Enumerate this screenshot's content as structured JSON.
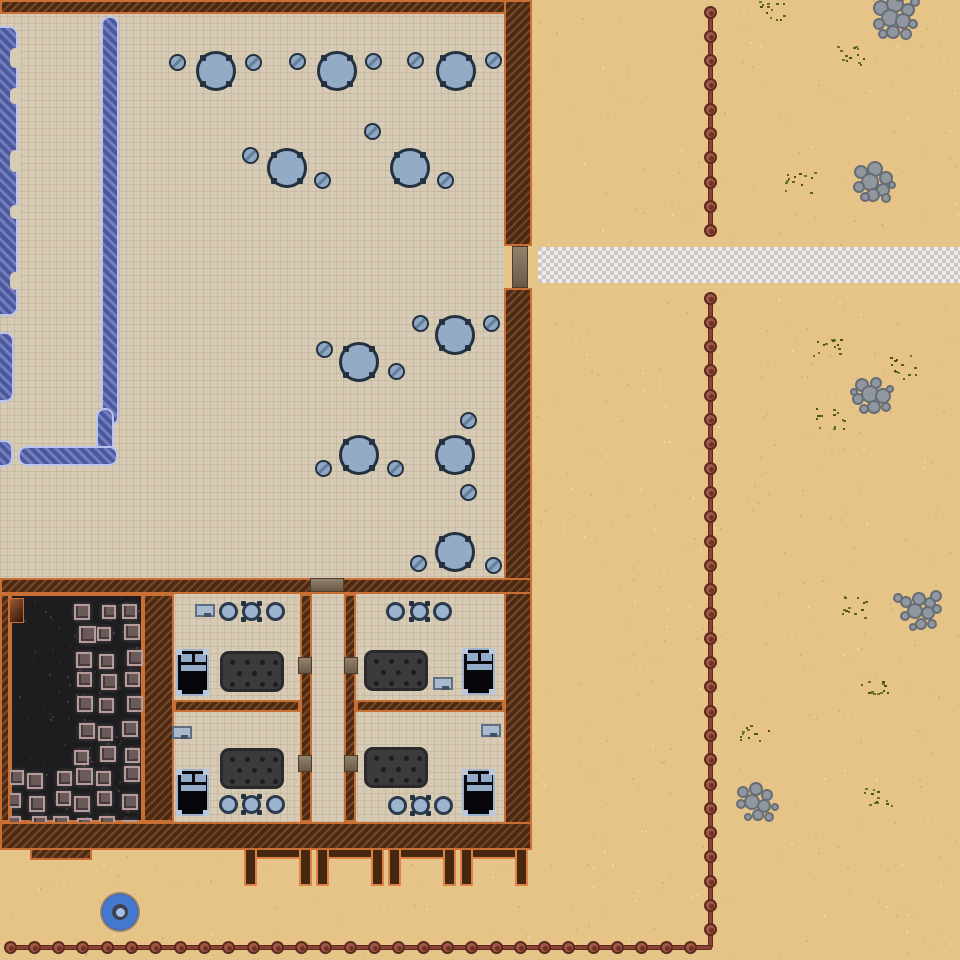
{
  "scene": {
    "type": "top-down-colony-map",
    "canvas": {
      "w": 960,
      "h": 960
    }
  },
  "palette": {
    "sand": "#e6c488",
    "floor": "#d8cbb6",
    "wall": "#4b2a15",
    "wall_edge": "#c96f33",
    "field": "#1d1c1e",
    "blueprint": "#4c589b",
    "blueprint_edge": "#b9c4ee",
    "table": "#94abc6",
    "outline": "#233140",
    "road_light": "#eeedea",
    "road_dark": "#c9c6c2",
    "fence": "#a05846",
    "rock": "#9097a0",
    "grass": "#5a641c",
    "door": "#8d7c66",
    "bed_frame": "#9db3cc",
    "rug": "#3b3b3d",
    "crate": "#6a5a5a",
    "crate_edge": "#b79b9b",
    "disc": "#4579cf"
  },
  "floors": [
    [
      0,
      14,
      504,
      808
    ]
  ],
  "walls": [
    [
      0,
      0,
      532,
      14
    ],
    [
      504,
      0,
      28,
      246
    ],
    [
      504,
      288,
      28,
      558
    ],
    [
      0,
      578,
      532,
      16
    ],
    [
      0,
      594,
      10,
      228
    ],
    [
      143,
      594,
      31,
      228
    ],
    [
      300,
      594,
      12,
      228
    ],
    [
      344,
      594,
      12,
      228
    ],
    [
      174,
      700,
      126,
      12
    ],
    [
      356,
      700,
      148,
      12
    ],
    [
      0,
      822,
      532,
      28
    ],
    [
      30,
      848,
      62,
      12
    ]
  ],
  "doors": [
    [
      512,
      246,
      16,
      42
    ],
    [
      310,
      578,
      34,
      14
    ],
    [
      298,
      657,
      14,
      17
    ],
    [
      344,
      657,
      14,
      17
    ],
    [
      298,
      755,
      14,
      17
    ],
    [
      344,
      755,
      14,
      17
    ]
  ],
  "road": [
    538,
    247,
    422,
    36
  ],
  "blueprints": {
    "strips": [
      [
        101,
        16,
        18,
        410
      ],
      [
        96,
        408,
        18,
        50
      ],
      [
        18,
        446,
        100,
        20
      ],
      [
        -8,
        26,
        26,
        290
      ],
      [
        -8,
        332,
        22,
        70
      ],
      [
        -8,
        440,
        21,
        27
      ]
    ],
    "notches": [
      [
        10,
        48,
        10,
        20
      ],
      [
        10,
        88,
        10,
        16
      ],
      [
        10,
        150,
        10,
        22
      ],
      [
        10,
        205,
        10,
        14
      ],
      [
        10,
        272,
        10,
        18
      ]
    ]
  },
  "tables": [
    [
      216,
      71
    ],
    [
      337,
      71
    ],
    [
      456,
      71
    ],
    [
      287,
      168
    ],
    [
      410,
      168
    ],
    [
      359,
      362
    ],
    [
      455,
      335
    ],
    [
      359,
      455
    ],
    [
      455,
      455
    ],
    [
      455,
      552
    ]
  ],
  "stools": [
    [
      177,
      62
    ],
    [
      253,
      62
    ],
    [
      297,
      61
    ],
    [
      373,
      61
    ],
    [
      415,
      60
    ],
    [
      493,
      60
    ],
    [
      250,
      155
    ],
    [
      322,
      180
    ],
    [
      372,
      131
    ],
    [
      445,
      180
    ],
    [
      324,
      349
    ],
    [
      396,
      371
    ],
    [
      420,
      323
    ],
    [
      491,
      323
    ],
    [
      323,
      468
    ],
    [
      395,
      468
    ],
    [
      468,
      420
    ],
    [
      468,
      492
    ],
    [
      418,
      563
    ],
    [
      493,
      565
    ]
  ],
  "bedrooms": {
    "beds": [
      [
        176,
        649
      ],
      [
        462,
        648
      ],
      [
        176,
        769
      ],
      [
        462,
        769
      ]
    ],
    "rugs": [
      [
        220,
        651
      ],
      [
        364,
        650
      ],
      [
        220,
        748
      ],
      [
        364,
        747
      ]
    ],
    "pots": [
      [
        228,
        611
      ],
      [
        251,
        611
      ],
      [
        275,
        611
      ],
      [
        395,
        611
      ],
      [
        419,
        611
      ],
      [
        442,
        611
      ],
      [
        228,
        804
      ],
      [
        251,
        804
      ],
      [
        275,
        804
      ],
      [
        397,
        805
      ],
      [
        420,
        805
      ],
      [
        443,
        805
      ]
    ],
    "pot_tab_indices": [
      1,
      4,
      7,
      10
    ],
    "dressers": [
      [
        195,
        604
      ],
      [
        433,
        677
      ],
      [
        172,
        726
      ],
      [
        481,
        724
      ]
    ]
  },
  "field": {
    "rect": [
      10,
      594,
      133,
      228
    ],
    "hopper": [
      2,
      598,
      22,
      25
    ],
    "crates": [
      [
        74,
        604,
        16
      ],
      [
        102,
        605,
        14
      ],
      [
        122,
        604,
        15
      ],
      [
        79,
        626,
        17
      ],
      [
        97,
        627,
        14
      ],
      [
        124,
        624,
        16
      ],
      [
        76,
        652,
        16
      ],
      [
        99,
        654,
        15
      ],
      [
        127,
        650,
        16
      ],
      [
        77,
        672,
        15
      ],
      [
        101,
        674,
        16
      ],
      [
        125,
        672,
        15
      ],
      [
        77,
        696,
        16
      ],
      [
        99,
        698,
        15
      ],
      [
        127,
        696,
        16
      ],
      [
        79,
        723,
        16
      ],
      [
        98,
        726,
        15
      ],
      [
        122,
        721,
        16
      ],
      [
        74,
        750,
        15
      ],
      [
        100,
        746,
        16
      ],
      [
        125,
        748,
        15
      ],
      [
        9,
        770,
        15
      ],
      [
        27,
        773,
        16
      ],
      [
        57,
        771,
        15
      ],
      [
        76,
        768,
        17
      ],
      [
        96,
        771,
        15
      ],
      [
        124,
        766,
        16
      ],
      [
        6,
        793,
        15
      ],
      [
        29,
        796,
        16
      ],
      [
        56,
        791,
        15
      ],
      [
        74,
        796,
        16
      ],
      [
        97,
        791,
        15
      ],
      [
        122,
        794,
        16
      ],
      [
        6,
        816,
        15
      ],
      [
        32,
        816,
        15
      ],
      [
        53,
        816,
        16
      ],
      [
        77,
        818,
        15
      ],
      [
        99,
        816,
        16
      ],
      [
        122,
        820,
        15
      ],
      [
        7,
        834,
        14
      ],
      [
        35,
        836,
        13
      ],
      [
        62,
        834,
        13
      ],
      [
        86,
        836,
        14
      ],
      [
        110,
        834,
        13
      ],
      [
        130,
        832,
        12
      ]
    ]
  },
  "porches": {
    "y": 846,
    "w": 68,
    "h": 40,
    "t": 13,
    "xs": [
      244,
      316,
      388,
      460
    ]
  },
  "fences": {
    "spacing": 24.3,
    "segments": [
      {
        "dir": "v",
        "x": 710,
        "from": 10,
        "to": 232
      },
      {
        "dir": "v",
        "x": 710,
        "from": 296,
        "to": 948
      },
      {
        "dir": "h",
        "y": 947,
        "from": 8,
        "to": 712
      }
    ]
  },
  "rocks": [
    {
      "c": [
        895,
        16
      ],
      "stones": [
        [
          -14,
          -8,
          8
        ],
        [
          0,
          -12,
          9
        ],
        [
          13,
          -6,
          7
        ],
        [
          -5,
          2,
          9
        ],
        [
          8,
          5,
          8
        ],
        [
          -16,
          8,
          6
        ],
        [
          18,
          8,
          5
        ],
        [
          -2,
          16,
          7
        ],
        [
          11,
          18,
          6
        ],
        [
          -12,
          18,
          5
        ],
        [
          5,
          -20,
          6
        ],
        [
          20,
          -14,
          5
        ]
      ]
    },
    {
      "c": [
        873,
        182
      ],
      "stones": [
        [
          -12,
          -10,
          7
        ],
        [
          2,
          -13,
          8
        ],
        [
          13,
          -4,
          7
        ],
        [
          -3,
          0,
          9
        ],
        [
          10,
          8,
          7
        ],
        [
          -14,
          5,
          6
        ],
        [
          0,
          13,
          7
        ],
        [
          13,
          16,
          5
        ],
        [
          -8,
          15,
          5
        ],
        [
          19,
          3,
          4
        ]
      ]
    },
    {
      "c": [
        872,
        396
      ],
      "stones": [
        [
          -10,
          -11,
          7
        ],
        [
          4,
          -13,
          6
        ],
        [
          -2,
          -2,
          9
        ],
        [
          11,
          0,
          8
        ],
        [
          -14,
          3,
          6
        ],
        [
          2,
          11,
          7
        ],
        [
          14,
          11,
          5
        ],
        [
          -8,
          13,
          5
        ],
        [
          18,
          -7,
          4
        ],
        [
          -18,
          -4,
          4
        ]
      ]
    },
    {
      "c": [
        920,
        612
      ],
      "stones": [
        [
          -14,
          -10,
          6
        ],
        [
          -1,
          -13,
          7
        ],
        [
          10,
          -9,
          6
        ],
        [
          -5,
          -1,
          8
        ],
        [
          8,
          1,
          7
        ],
        [
          -15,
          4,
          5
        ],
        [
          1,
          12,
          6
        ],
        [
          12,
          12,
          5
        ],
        [
          -7,
          15,
          4
        ],
        [
          17,
          -3,
          5
        ],
        [
          -22,
          -14,
          5
        ],
        [
          16,
          -16,
          6
        ]
      ]
    },
    {
      "c": [
        758,
        802
      ],
      "stones": [
        [
          -15,
          -10,
          6
        ],
        [
          -2,
          -13,
          7
        ],
        [
          9,
          -7,
          6
        ],
        [
          -6,
          0,
          8
        ],
        [
          6,
          4,
          7
        ],
        [
          -17,
          2,
          5
        ],
        [
          0,
          13,
          6
        ],
        [
          11,
          15,
          5
        ],
        [
          17,
          5,
          4
        ],
        [
          -10,
          15,
          4
        ]
      ]
    }
  ],
  "grass": [
    [
      775,
      12
    ],
    [
      852,
      58
    ],
    [
      800,
      182
    ],
    [
      828,
      345
    ],
    [
      905,
      368
    ],
    [
      830,
      420
    ],
    [
      855,
      608
    ],
    [
      878,
      688
    ],
    [
      757,
      732
    ],
    [
      878,
      798
    ]
  ],
  "disc": {
    "c": [
      120,
      912
    ],
    "r": 20
  }
}
